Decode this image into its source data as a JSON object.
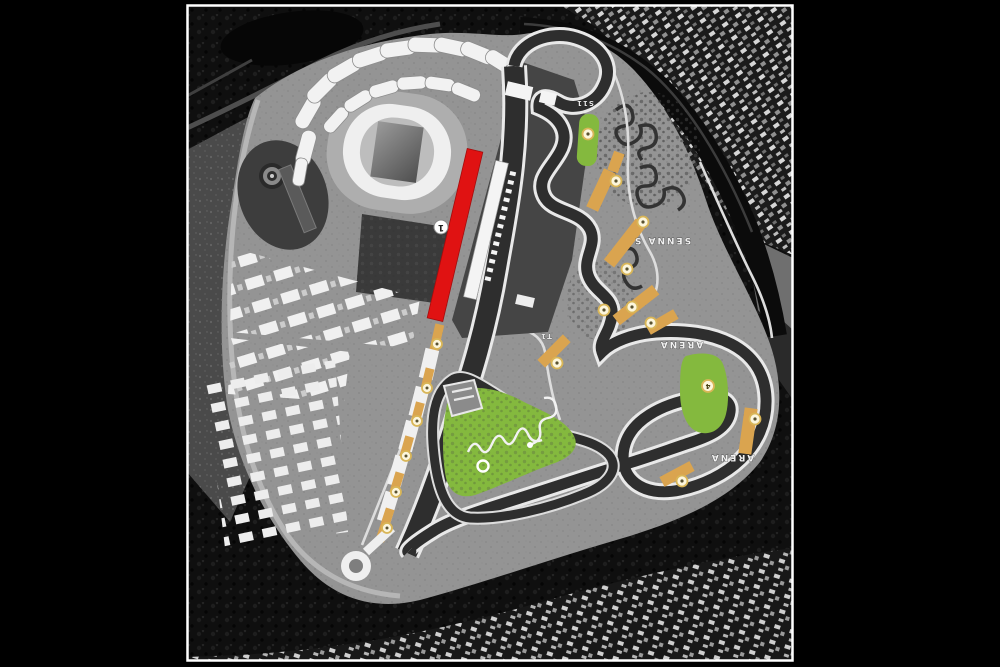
{
  "map": {
    "labels": {
      "senna_s": "SENNA S",
      "arena_upper": "ARENA",
      "arena_lower": "ARENA",
      "corner_s11": "S11",
      "corner_t1": "T1"
    },
    "pit_marker": {
      "label": "1"
    },
    "markers": [
      {
        "x": 588,
        "y": 134,
        "label": ""
      },
      {
        "x": 616,
        "y": 181,
        "label": ""
      },
      {
        "x": 643,
        "y": 222,
        "label": ""
      },
      {
        "x": 627,
        "y": 269,
        "label": ""
      },
      {
        "x": 604,
        "y": 310,
        "label": ""
      },
      {
        "x": 632,
        "y": 307,
        "label": ""
      },
      {
        "x": 651,
        "y": 323,
        "label": ""
      },
      {
        "x": 557,
        "y": 363,
        "label": ""
      },
      {
        "x": 708,
        "y": 386,
        "label": "4"
      },
      {
        "x": 755,
        "y": 419,
        "label": ""
      },
      {
        "x": 682,
        "y": 481,
        "label": ""
      },
      {
        "x": 483,
        "y": 466,
        "label": ""
      },
      {
        "x": 437,
        "y": 344,
        "label": ""
      },
      {
        "x": 427,
        "y": 388,
        "label": ""
      },
      {
        "x": 417,
        "y": 421,
        "label": ""
      },
      {
        "x": 406,
        "y": 456,
        "label": ""
      },
      {
        "x": 396,
        "y": 492,
        "label": ""
      },
      {
        "x": 387,
        "y": 528,
        "label": ""
      }
    ],
    "colors": {
      "background": "#000000",
      "map_frame": "#ffffff",
      "track_asphalt": "#2e2e2e",
      "track_edge": "#e9e9e9",
      "paved_area": "#949494",
      "grandstand_red": "#e01212",
      "grandstand_tan": "#daa44f",
      "grass_green": "#84b93e",
      "pit_building": "#f4f4f4",
      "marker_fill": "#fcf6dd",
      "marker_ring": "#d9b657",
      "stadium_ring": "#efefef"
    }
  }
}
